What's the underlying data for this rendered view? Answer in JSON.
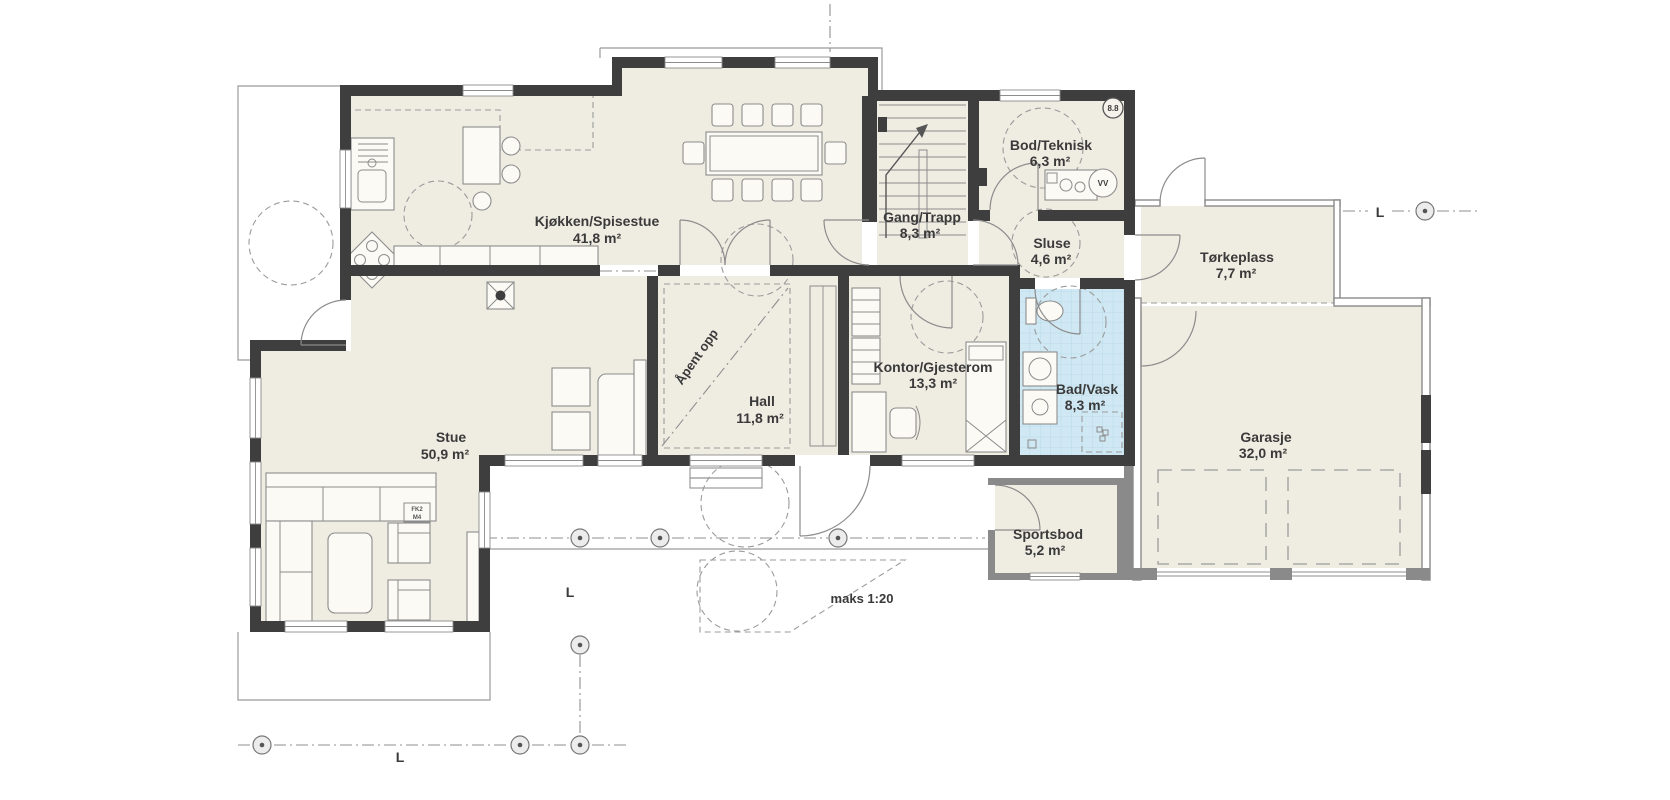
{
  "plan": {
    "rooms": [
      {
        "name": "Kjøkken/Spisestue",
        "area": "41,8 m²"
      },
      {
        "name": "Gang/Trapp",
        "area": "8,3 m²"
      },
      {
        "name": "Bod/Teknisk",
        "area": "6,3 m²"
      },
      {
        "name": "Sluse",
        "area": "4,6 m²"
      },
      {
        "name": "Tørkeplass",
        "area": "7,7 m²"
      },
      {
        "name": "Hall",
        "area": "11,8 m²"
      },
      {
        "name": "Kontor/Gjesterom",
        "area": "13,3 m²"
      },
      {
        "name": "Bad/Vask",
        "area": "8,3 m²"
      },
      {
        "name": "Stue",
        "area": "50,9 m²"
      },
      {
        "name": "Sportsbod",
        "area": "5,2 m²"
      },
      {
        "name": "Garasje",
        "area": "32,0 m²"
      }
    ],
    "annotations": {
      "open_above": "Åpent opp",
      "ramp": "maks 1:20",
      "section_bubble": "8.8",
      "water_heater": "VV",
      "section_line": "L",
      "detail_code_1": "FK2",
      "detail_code_2": "M4"
    },
    "colors": {
      "floor": "#efece2",
      "bath_floor": "#cfe8f3",
      "wall": "#3e3e3e",
      "unheated_wall": "#8a8a8a",
      "outline": "#9b9b9b",
      "background": "#ffffff"
    }
  }
}
